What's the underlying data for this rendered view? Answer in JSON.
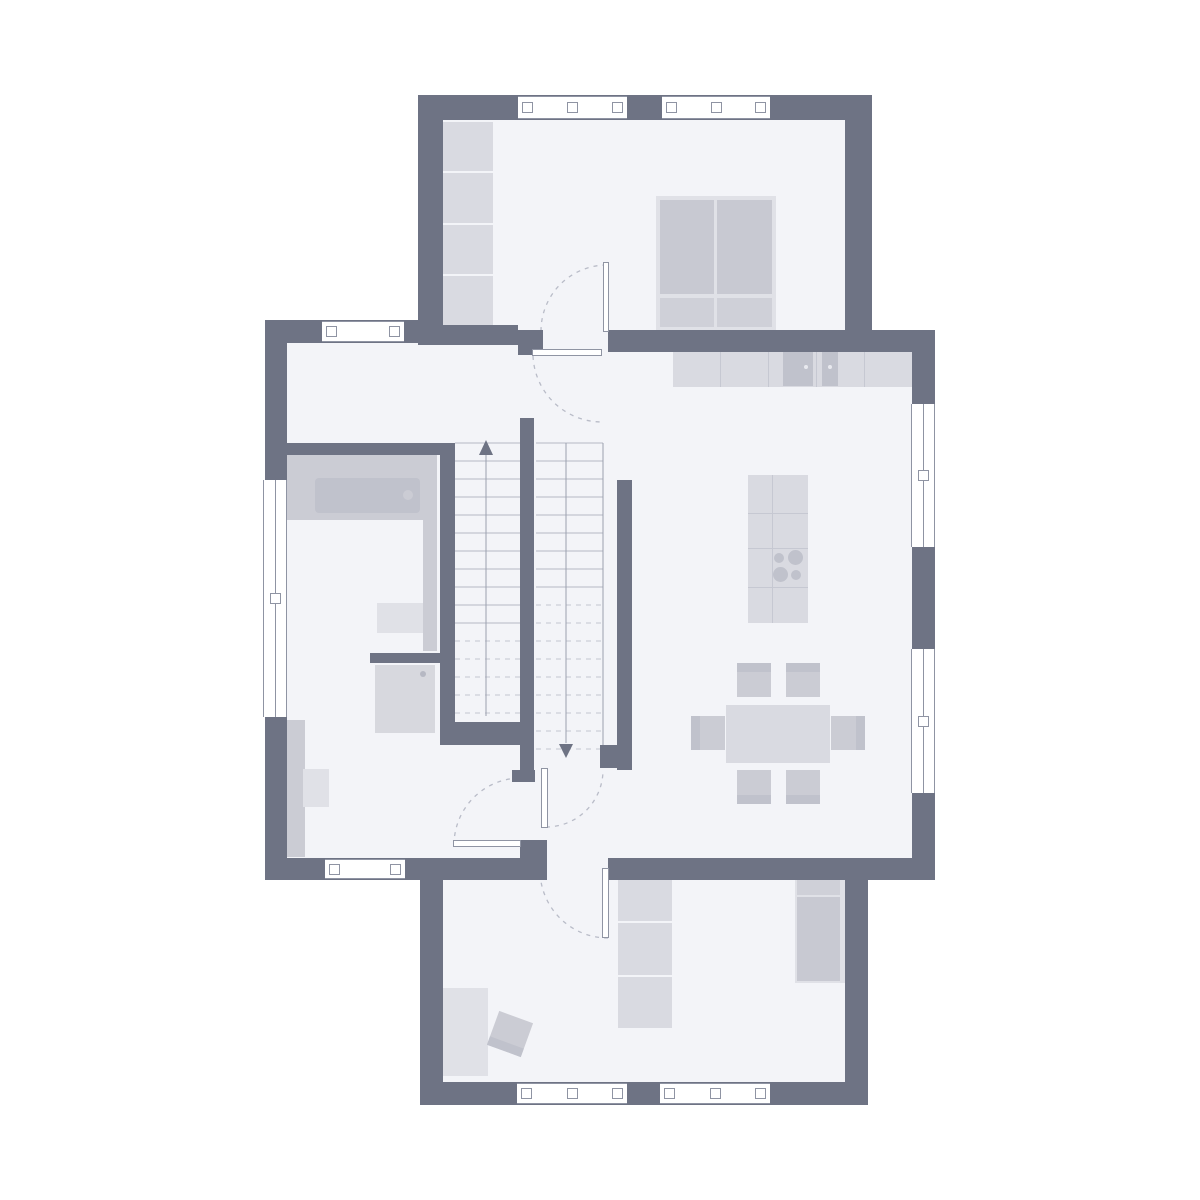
{
  "title": "floor-plan",
  "palette": {
    "bg": "#ffffff",
    "wall": "#6e7384",
    "room": "#f3f4f8",
    "furn_light": "#d9dae1",
    "furn_mid": "#cbccd4",
    "furn_dark": "#c0c2cc",
    "furn_pale": "#e0e1e7",
    "mattress": "#c8c9d2",
    "pillow": "#cfd0d8",
    "line": "#8f94a3",
    "tread": "#b4b8c4",
    "dash": "#b9bcc8",
    "arrow": "#6e7384"
  },
  "icons": {
    "stairs_up_arrow": "triangle-up",
    "stairs_down_arrow": "triangle-down",
    "door_swing": "dashed-quarter-arc",
    "window": "white-band-with-panes",
    "cooktop_burners": "four-circles"
  },
  "legend": {
    "stairs": "two parallel flights, solid treads below cut line, dashed above",
    "doors": "white leaf with dashed swing arc",
    "walls": "solid dark grey bands",
    "windows": "white bands with pane marks inside walls"
  }
}
